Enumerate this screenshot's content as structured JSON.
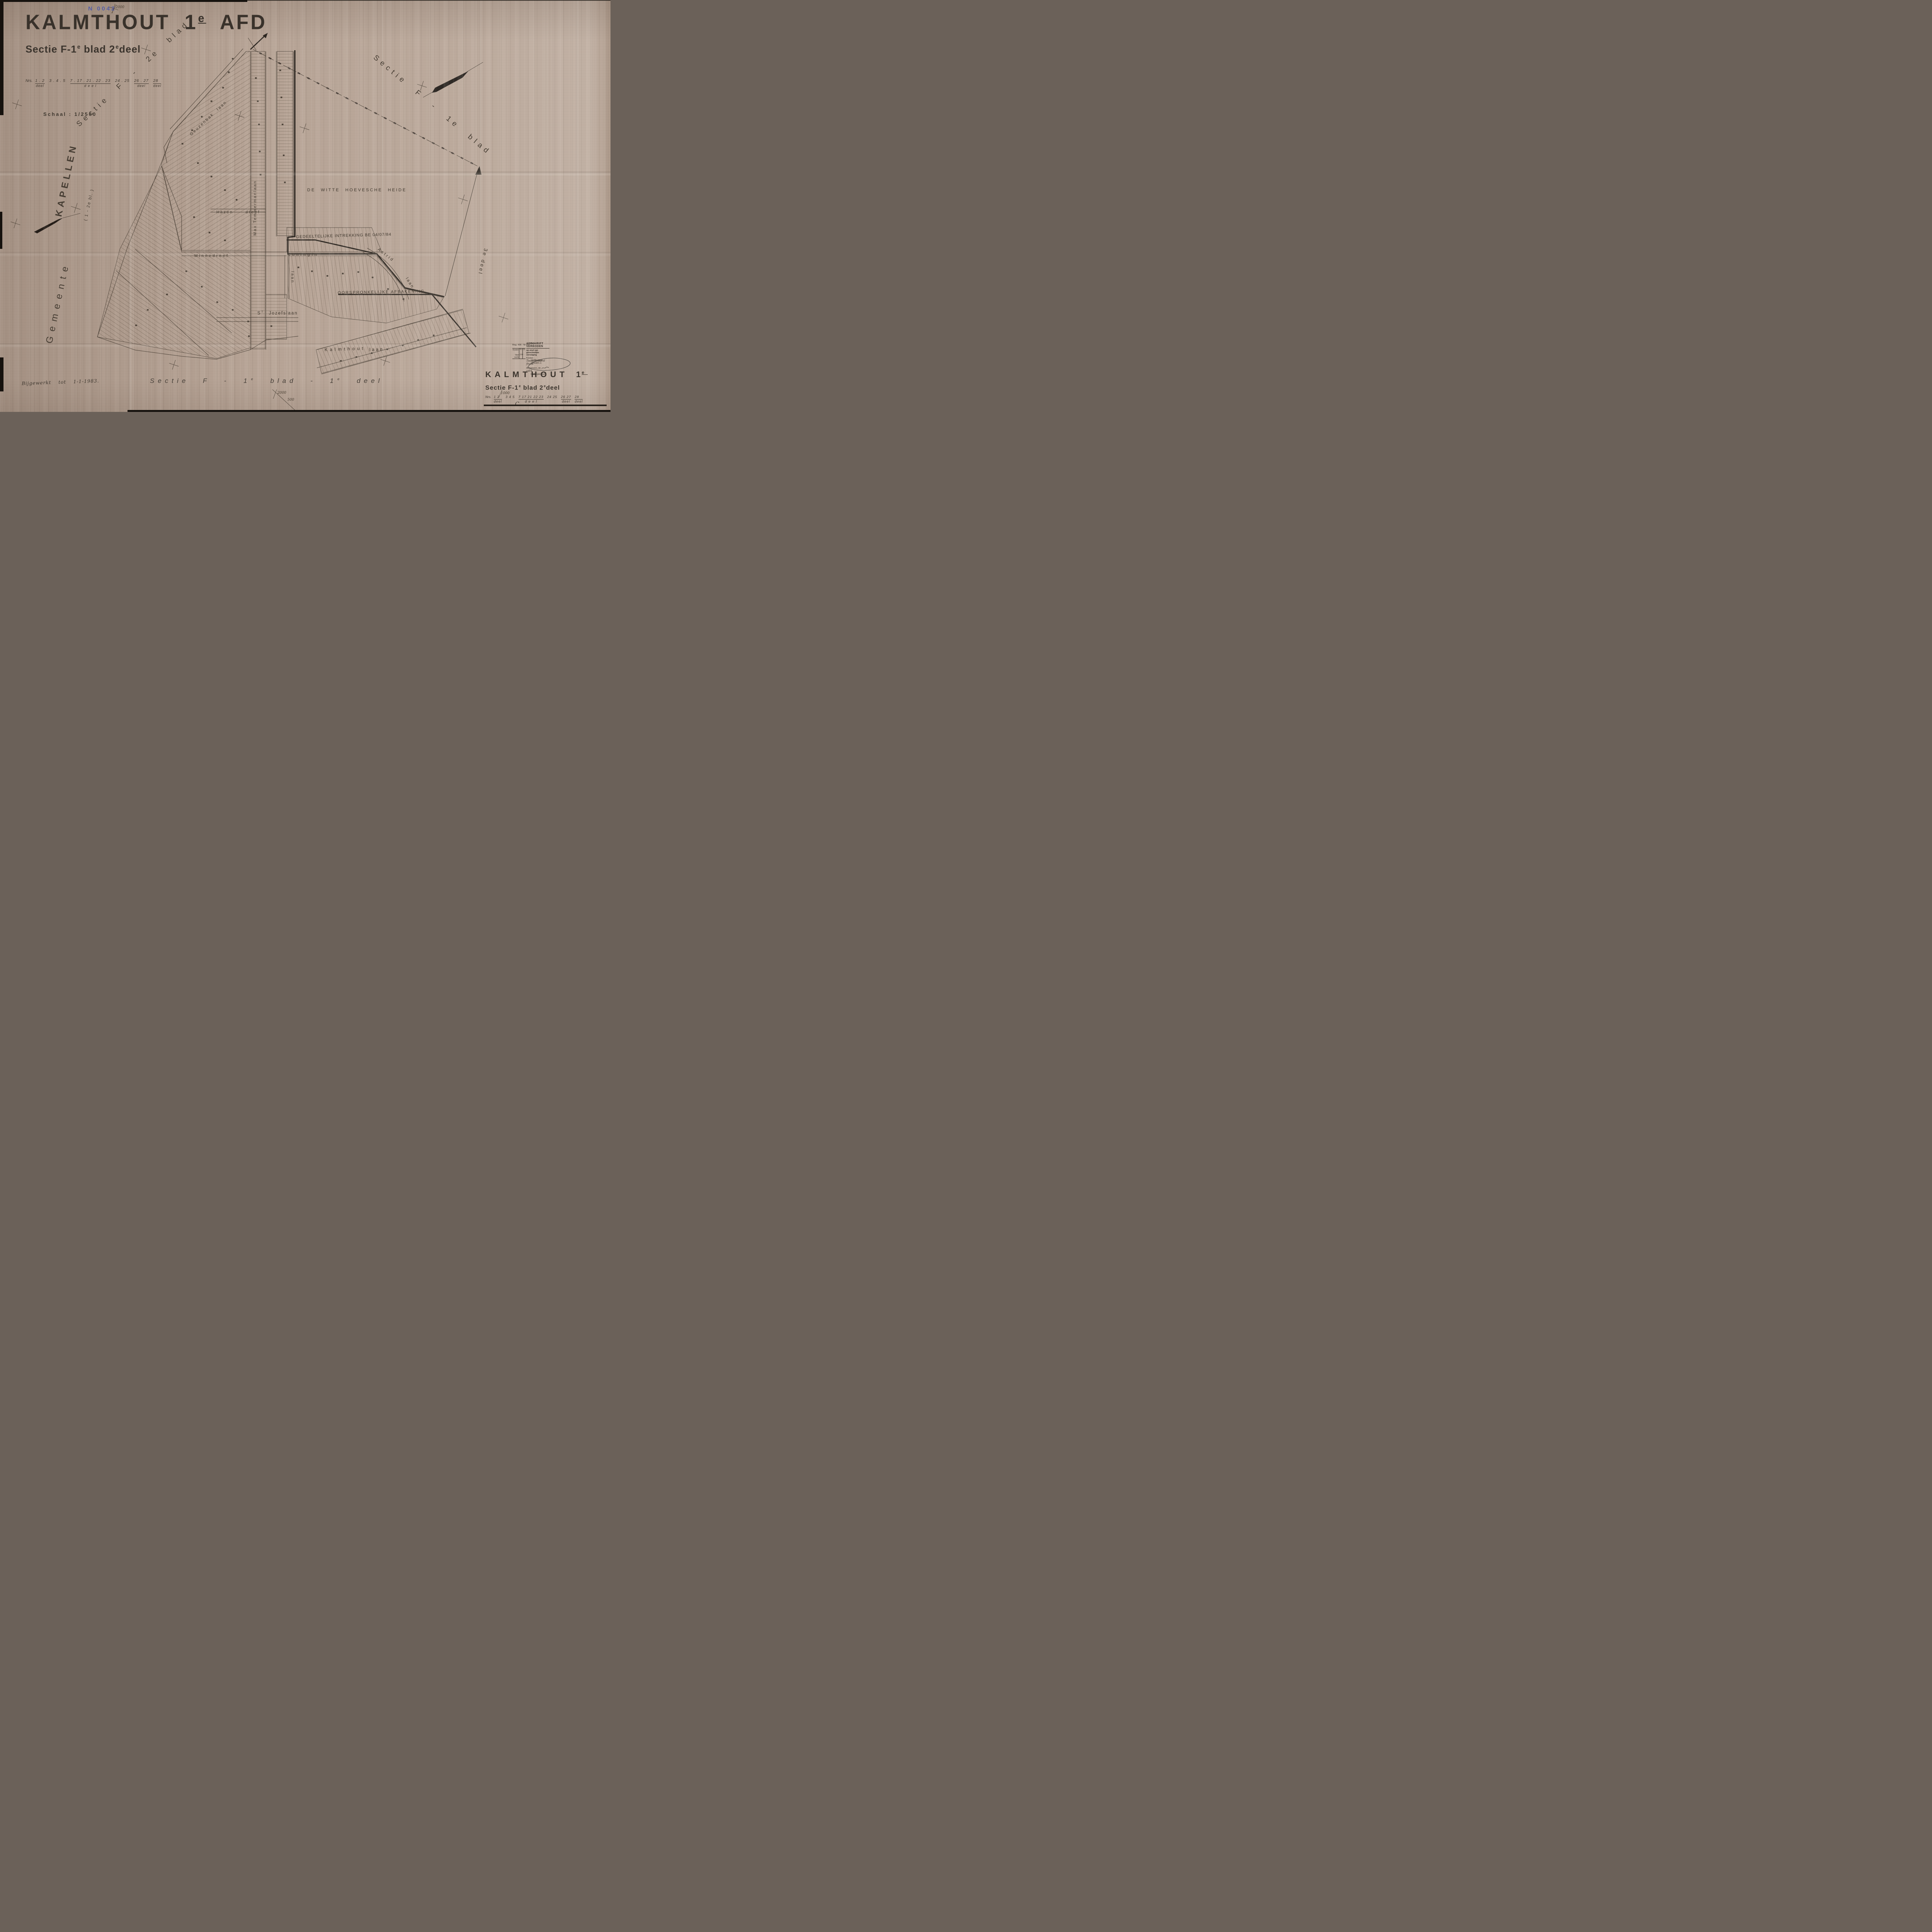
{
  "page": {
    "paper_color": "#b6a395",
    "ink_color": "#3a332c",
    "map_ink_color": "#4a4034",
    "stamp_blue": "#4a57a9"
  },
  "header": {
    "city": "KALMTHOUT",
    "num": "1",
    "sup": "e",
    "afd": "AFD",
    "stamp_no": "N 0042",
    "tick": "2000",
    "sub_p1": "Sectie F-1",
    "sub_s1": "e",
    "sub_p2": "blad 2",
    "sub_s2": "e",
    "sub_p3": "deel",
    "nrs_label": "Nrs.",
    "nrs_groups": [
      {
        "nums": "1 . 2",
        "label": "deel"
      },
      {
        "nums": "3 . 4 . 5",
        "label": ""
      },
      {
        "nums": "7 . 17 . 21 . 22 . 23",
        "label": "d e e l"
      },
      {
        "nums": "24 . 25",
        "label": ""
      },
      {
        "nums": "26 . 27",
        "label": "deel"
      },
      {
        "nums": "28",
        "label": "deel"
      }
    ],
    "schaal": "Schaal : 1/2500"
  },
  "margins": {
    "sectie_f2": "Sectie  F  -  2e  blad",
    "sectie_f1": "Sectie  F  -  1e  blad",
    "gemeente": "Gemeente",
    "kapellen": "KAPELLEN",
    "kapellen_note": "( 1 - 2e bl. )",
    "deel3": "3e deel"
  },
  "map": {
    "heide": "DE WITTE HOEVESCHE HEIDE",
    "intrekking": "GEDEELTELIJKE INTREKKING BE 04/07/84",
    "afbakening": "OORSPRONKELIJKE AFBAKENING",
    "streets": {
      "geuzenbak": "Geuzenbak laan",
      "hazen": "Hazen dreef",
      "minnedreef": "Minnedreef",
      "temmerman": "Max Temmermanlaan",
      "koningin": "Koningin",
      "koningin_laan": "laan",
      "astrid": "Astrid",
      "astrid_laan": "laan",
      "jozef_s": "S",
      "jozef_sup": "T",
      "jozef_rest": "Jozefslaan",
      "kalmthout": "Kalmthout",
      "kalmthout_laan": "laan"
    }
  },
  "stamp": {
    "reg": "Reg. 436 : Nr",
    "verboden": "AFSCHRIFT VERBODEN",
    "straf": "op straf van gerechtelijke vervolging",
    "kosten": "Kosten :",
    "fr": "Fr.",
    "ct": "Ct.",
    "vast": "Vast recht",
    "bedrag": "200",
    "streep": "-",
    "kosten2": "Kosten :",
    "kosten_hand": "Tweehonderd frank",
    "antwerpen": "Antwerpen, de",
    "jaar": "19",
    "jaar_hand": "84",
    "inspecteur": "De Inspecteur",
    "verificateur": "Verificateur",
    "officiers": "Officiers J."
  },
  "footer": {
    "bijgewerkt": "Bijgewerkt tot 1-1-1983.",
    "center_p1": "Sectie  F  -  1",
    "center_s1": "e",
    "center_p2": "blad  -  1",
    "center_s2": "e",
    "center_p3": "deel",
    "tick_2000": "2000",
    "tick_500": "500",
    "right": {
      "city": "KALMTHOUT",
      "num": "1",
      "sup": "e",
      "sub_p1": "Sectie F-1",
      "sub_s1": "e",
      "sub_p2": "blad 2",
      "sub_s2": "e",
      "sub_p3": "deel",
      "nrs_label": "Nrs.",
      "nrs_groups": [
        {
          "nums": "1  2",
          "label": "deel"
        },
        {
          "nums": "3  4  5",
          "label": ""
        },
        {
          "nums": "7  17  21  22  23",
          "label": "d e e l"
        },
        {
          "nums": "24  25",
          "label": ""
        },
        {
          "nums": "26  27",
          "label": "deel"
        },
        {
          "nums": "28",
          "label": "deel"
        }
      ],
      "tick_1000": "1000",
      "mark_c": "C"
    }
  }
}
